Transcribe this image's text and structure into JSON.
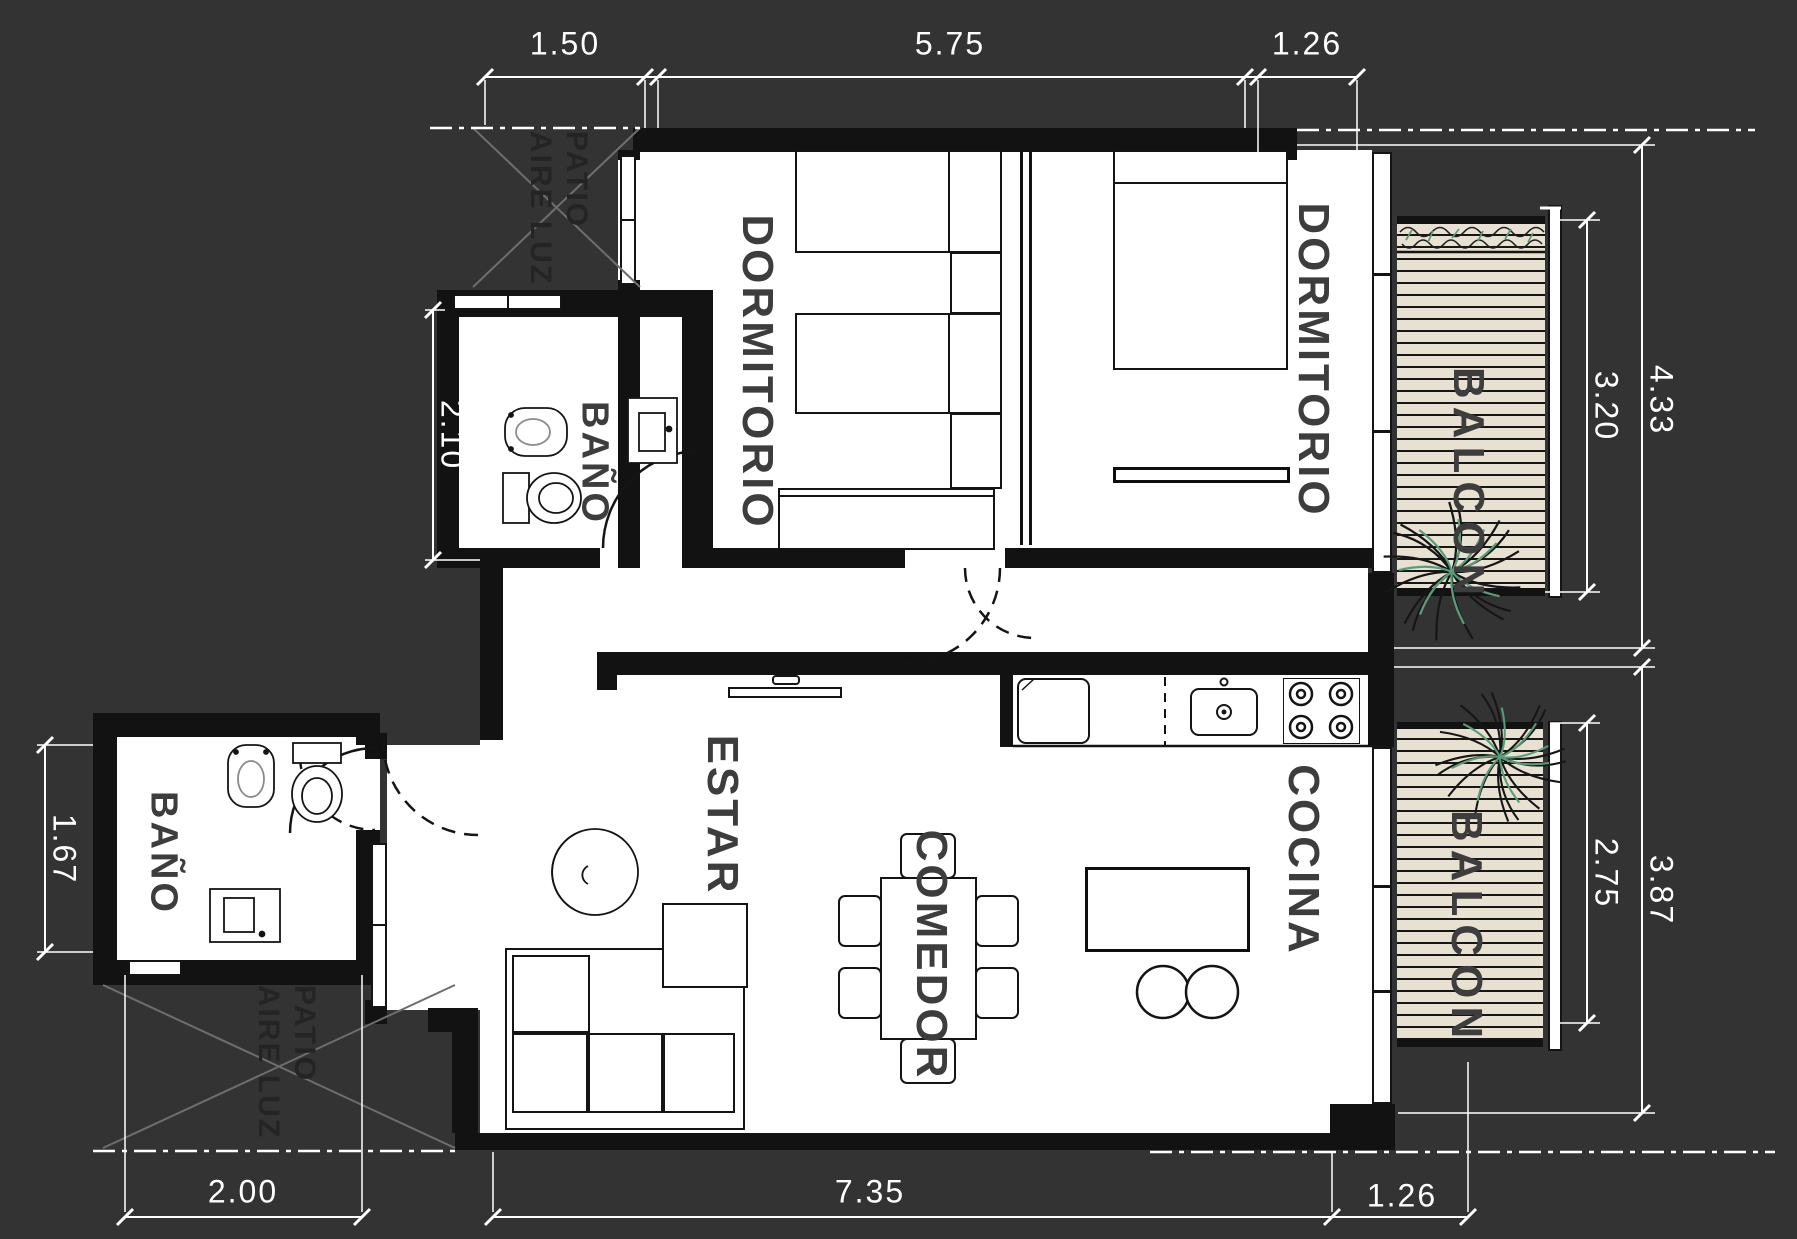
{
  "labels": {
    "bedroom_left": "DORMITORIO",
    "bedroom_right": "DORMITORIO",
    "bath_top": "BAÑO",
    "bath_bottom": "BAÑO",
    "living": "ESTAR",
    "dining": "COMEDOR",
    "kitchen": "COCINA",
    "balcony_top": "BALCON",
    "balcony_bottom": "BALCON",
    "patio_top_line1": "PATIO",
    "patio_top_line2": "AIRE LUZ",
    "patio_bottom_line1": "PATIO",
    "patio_bottom_line2": "AIRE LUZ"
  },
  "dimensions": {
    "top": [
      "1.50",
      "5.75",
      "1.26"
    ],
    "bottom": [
      "2.00",
      "7.35",
      "1.26"
    ],
    "left": [
      "2.10",
      "1.67"
    ],
    "right": [
      "3.20",
      "4.33",
      "2.75",
      "3.87"
    ]
  },
  "colors": {
    "background": "#333333",
    "floor": "#ffffff",
    "wall": "#121212",
    "deck": "#e8e0d0",
    "dimension_text": "#ffffff",
    "room_label": "#3d3d3d",
    "patio_label": "#242424",
    "plant_green": "#5a9b79"
  }
}
